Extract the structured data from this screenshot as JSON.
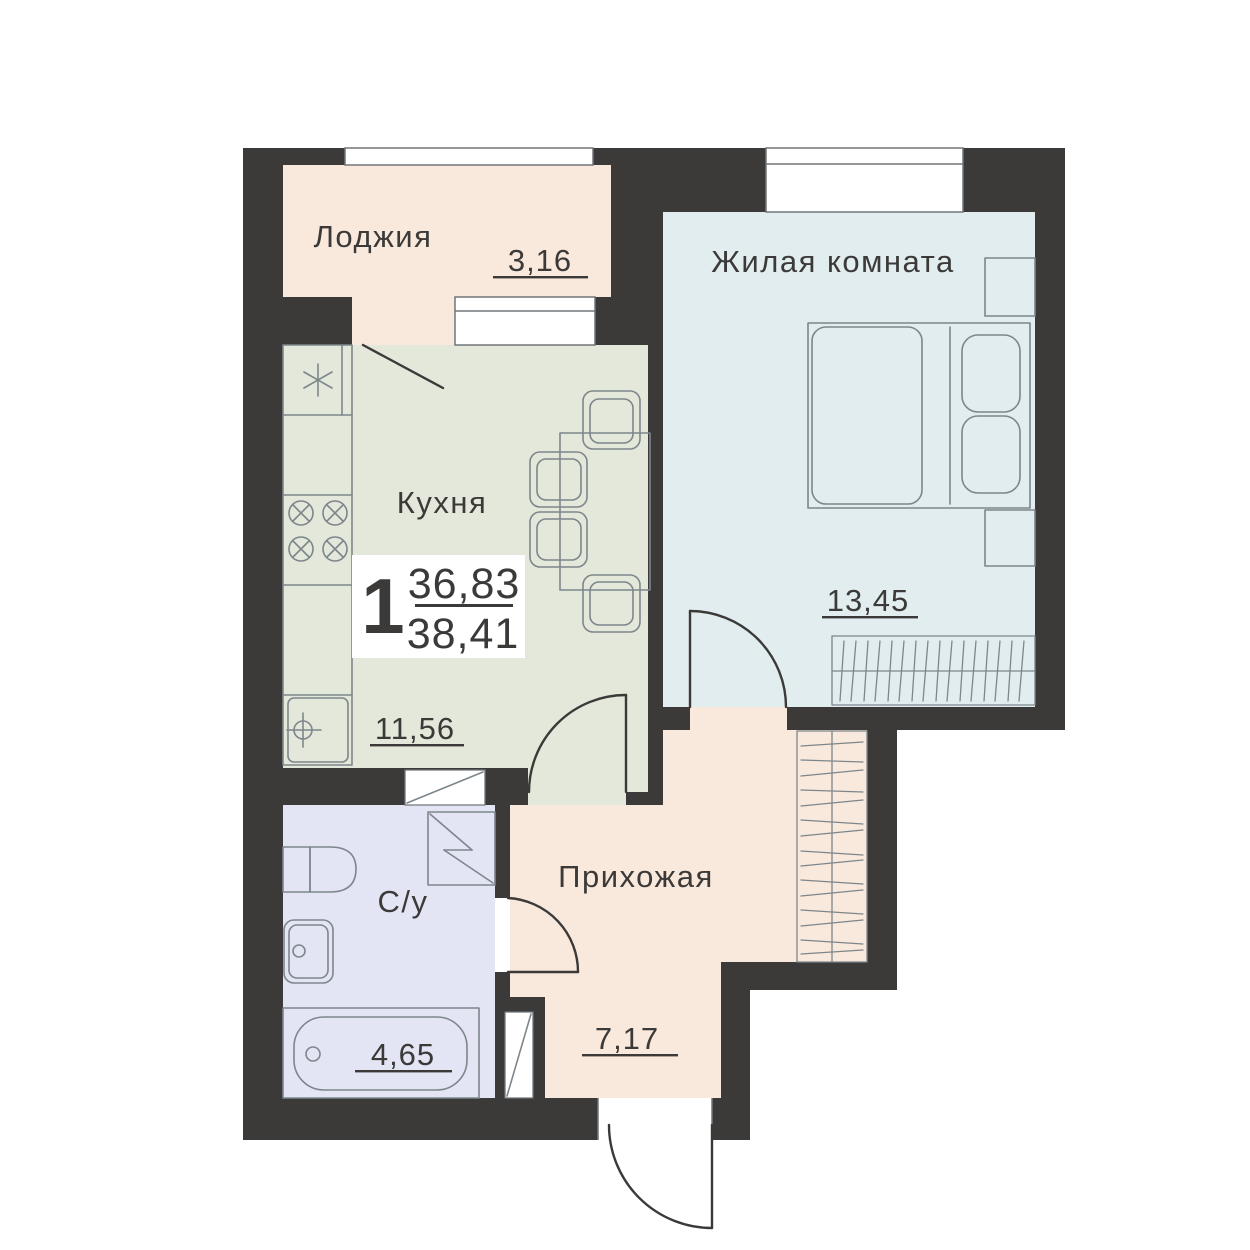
{
  "plan": {
    "apartment_number": "1",
    "area_living": "36,83",
    "area_total": "38,41",
    "rooms": [
      {
        "name": "Лоджия",
        "area": "3,16"
      },
      {
        "name": "Жилая комната",
        "area": "13,45"
      },
      {
        "name": "Кухня",
        "area": "11,56"
      },
      {
        "name": "Прихожая",
        "area": "7,17"
      },
      {
        "name": "С/у",
        "area": "4,65"
      }
    ],
    "colors": {
      "wall": "#3b3a38",
      "loggia": "#f9e8dc",
      "living": "#e2edf0",
      "kitchen": "#e3e8da",
      "hallway": "#f9e8dc",
      "bathroom": "#e3e5f5",
      "furniture_stroke": "#7d868b",
      "door": "#3b3a38",
      "text": "#3b3a38"
    }
  }
}
